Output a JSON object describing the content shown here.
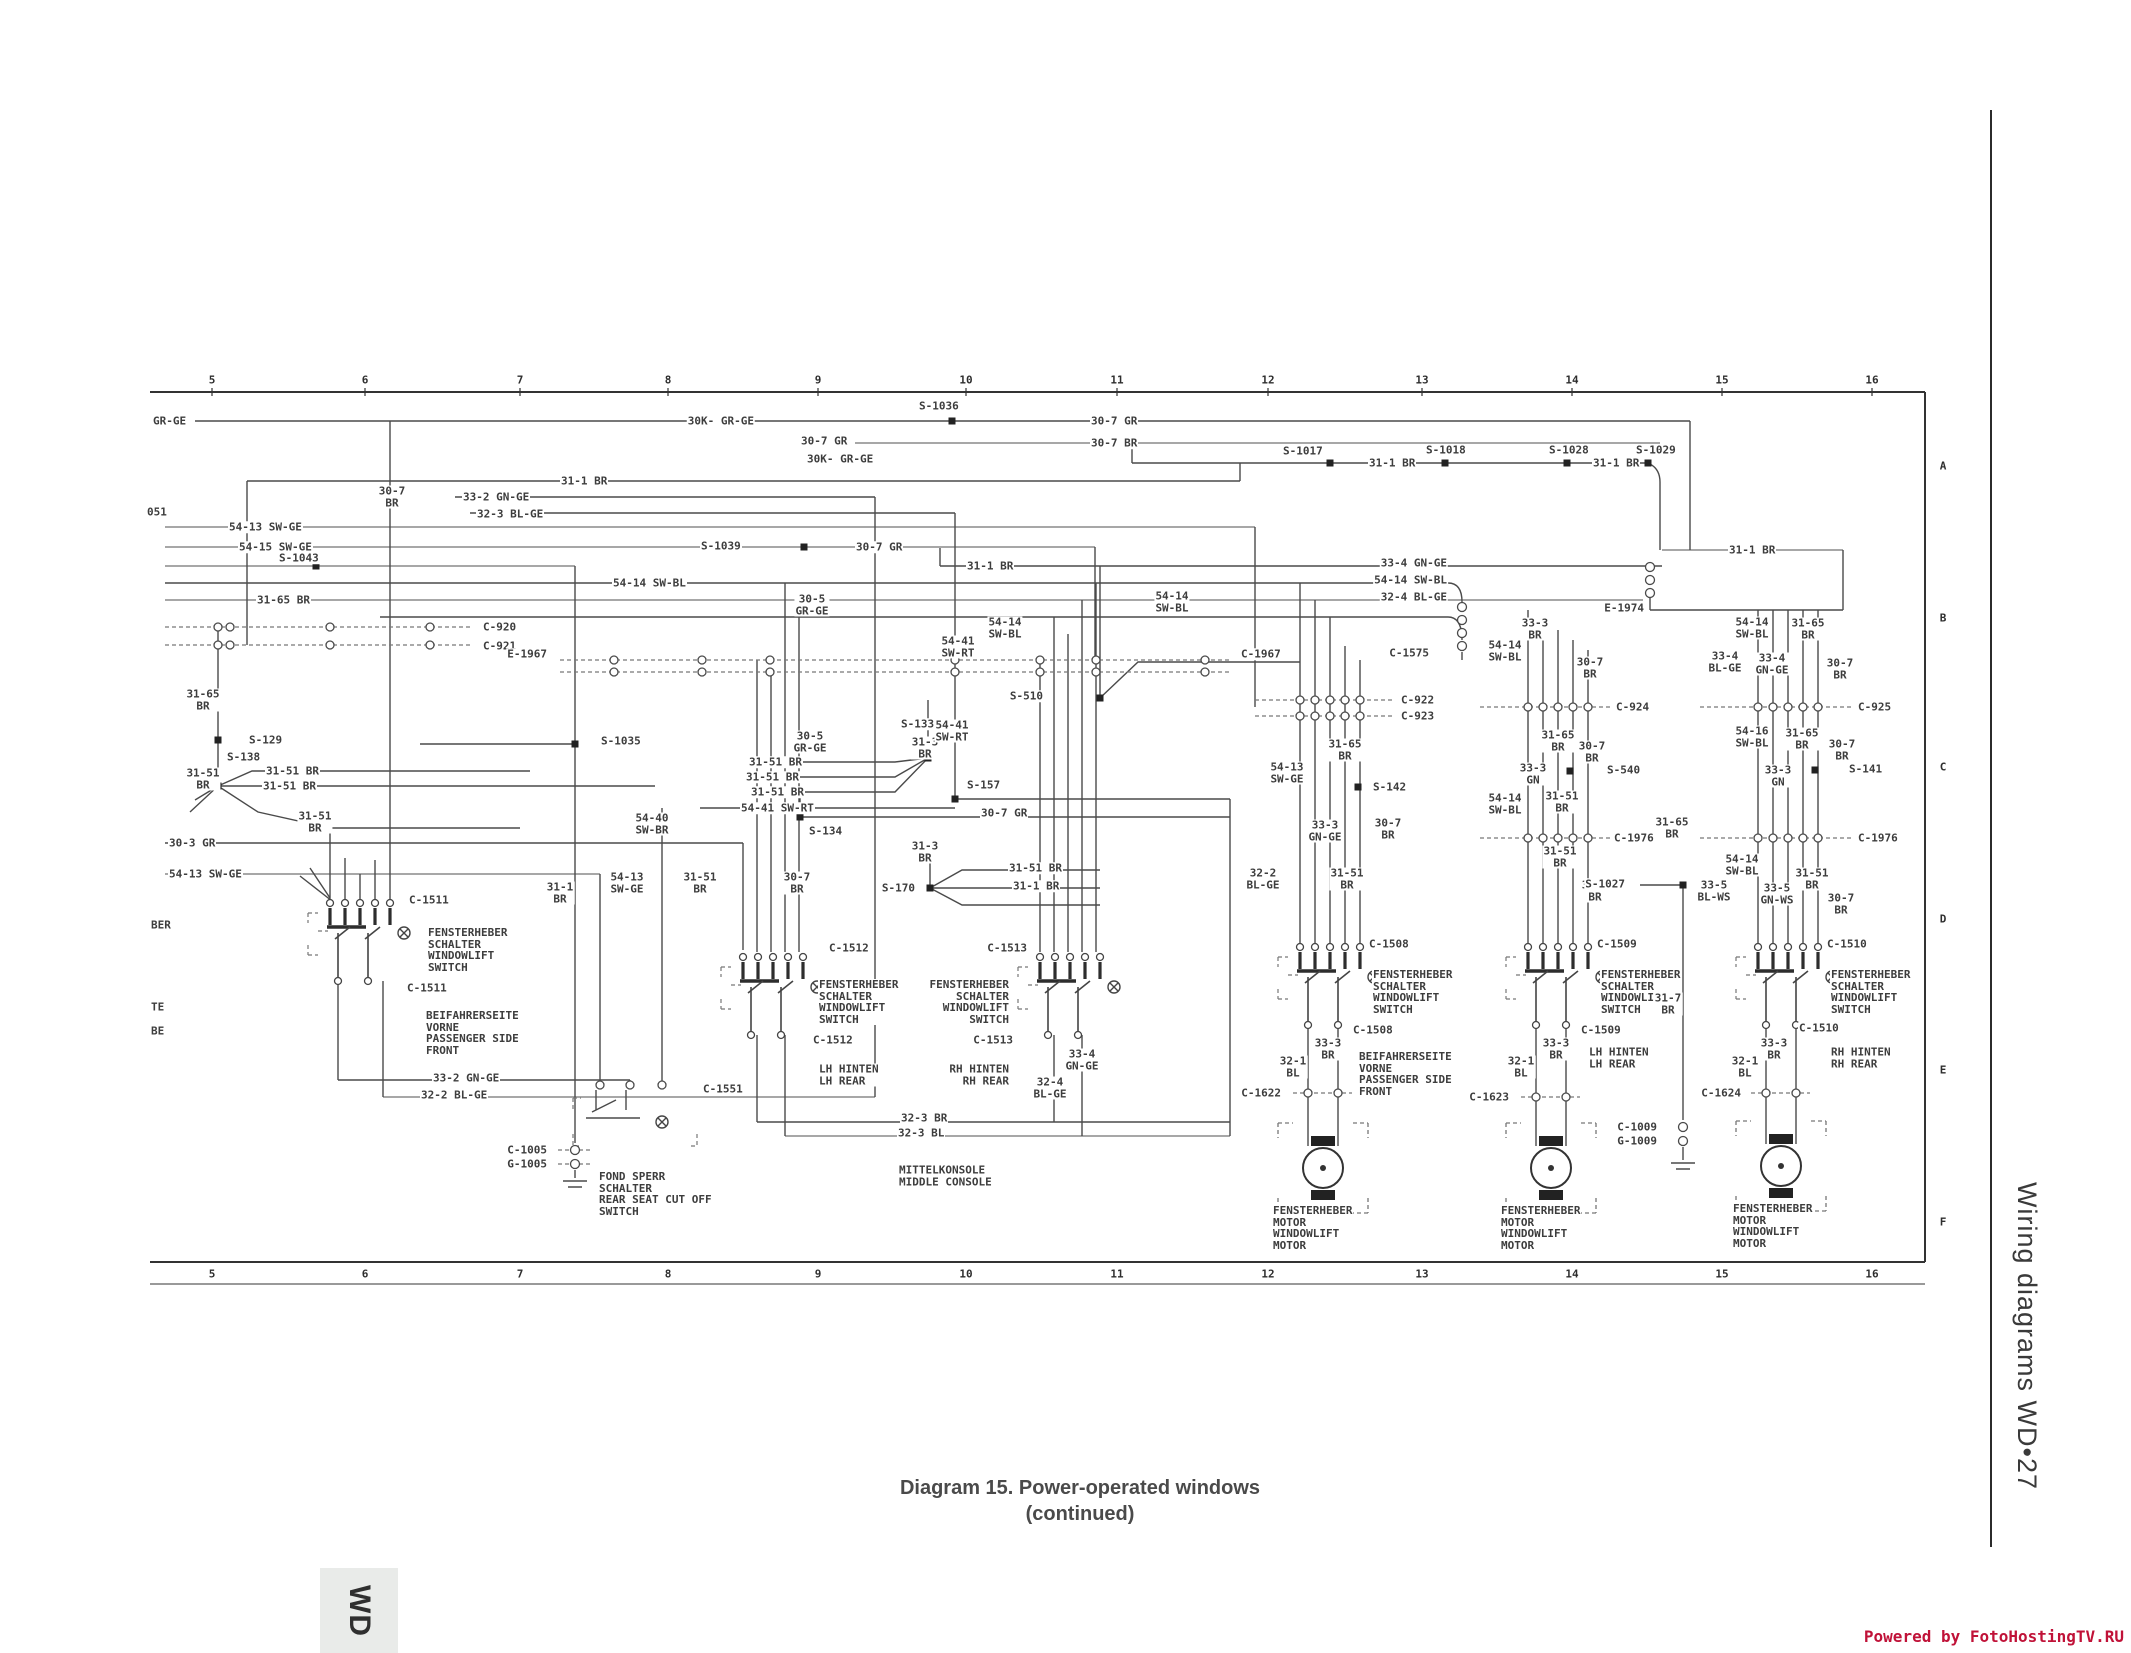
{
  "page": {
    "caption_line1": "Diagram 15. Power-operated windows",
    "caption_line2": "(continued)",
    "sidebar_text": "Wiring diagrams  WD•27",
    "tab_label": "WD",
    "footer_text": "Powered by FotoHostingTV.RU",
    "footer_color": "#c01238"
  },
  "grid": {
    "top_y": 380,
    "bottom_y": 1274,
    "letters_x": 1943,
    "columns": [
      {
        "t": "5",
        "x": 212
      },
      {
        "t": "6",
        "x": 365
      },
      {
        "t": "7",
        "x": 520
      },
      {
        "t": "8",
        "x": 668
      },
      {
        "t": "9",
        "x": 818
      },
      {
        "t": "10",
        "x": 966
      },
      {
        "t": "11",
        "x": 1117
      },
      {
        "t": "12",
        "x": 1268
      },
      {
        "t": "13",
        "x": 1422
      },
      {
        "t": "14",
        "x": 1572
      },
      {
        "t": "15",
        "x": 1722
      },
      {
        "t": "16",
        "x": 1872
      }
    ],
    "letters": [
      {
        "t": "A",
        "y": 466
      },
      {
        "t": "B",
        "y": 618
      },
      {
        "t": "C",
        "y": 767
      },
      {
        "t": "D",
        "y": 919
      },
      {
        "t": "E",
        "y": 1070
      },
      {
        "t": "F",
        "y": 1222
      }
    ]
  },
  "labels": [
    {
      "t": "GR-GE",
      "x": 152,
      "y": 421,
      "a": "s"
    },
    {
      "t": "30K- GR-GE",
      "x": 755,
      "y": 421,
      "a": "e"
    },
    {
      "t": "S-1036",
      "x": 918,
      "y": 406,
      "a": "s"
    },
    {
      "t": "30-7 GR",
      "x": 800,
      "y": 441,
      "a": "s"
    },
    {
      "t": "30K- GR-GE",
      "x": 806,
      "y": 459,
      "a": "s"
    },
    {
      "t": "30-7 GR",
      "x": 1090,
      "y": 421,
      "a": "s"
    },
    {
      "t": "30-7 BR",
      "x": 1090,
      "y": 443,
      "a": "s"
    },
    {
      "t": "31-1 BR",
      "x": 560,
      "y": 481,
      "a": "s"
    },
    {
      "t": "30-7\nBR",
      "x": 392,
      "y": 497,
      "a": "m"
    },
    {
      "t": "33-2 GN-GE",
      "x": 462,
      "y": 497,
      "a": "s"
    },
    {
      "t": "32-3 BL-GE",
      "x": 476,
      "y": 514,
      "a": "s"
    },
    {
      "t": "051",
      "x": 146,
      "y": 512,
      "a": "s"
    },
    {
      "t": "54-13 SW-GE",
      "x": 228,
      "y": 527,
      "a": "s"
    },
    {
      "t": "54-15 SW-GE",
      "x": 238,
      "y": 547,
      "a": "s"
    },
    {
      "t": "S-1043",
      "x": 278,
      "y": 558,
      "a": "s"
    },
    {
      "t": "S-1039",
      "x": 700,
      "y": 546,
      "a": "s"
    },
    {
      "t": "30-7 GR",
      "x": 855,
      "y": 547,
      "a": "s"
    },
    {
      "t": "31-1 BR",
      "x": 966,
      "y": 566,
      "a": "s"
    },
    {
      "t": "S-1017",
      "x": 1282,
      "y": 451,
      "a": "s"
    },
    {
      "t": "31-1 BR",
      "x": 1368,
      "y": 463,
      "a": "s"
    },
    {
      "t": "S-1018",
      "x": 1425,
      "y": 450,
      "a": "s"
    },
    {
      "t": "S-1028",
      "x": 1548,
      "y": 450,
      "a": "s"
    },
    {
      "t": "31-1 BR",
      "x": 1592,
      "y": 463,
      "a": "s"
    },
    {
      "t": "S-1029",
      "x": 1635,
      "y": 450,
      "a": "s"
    },
    {
      "t": "31-1 BR",
      "x": 1728,
      "y": 550,
      "a": "s"
    },
    {
      "t": "31-65 BR",
      "x": 256,
      "y": 600,
      "a": "s"
    },
    {
      "t": "54-14 SW-BL",
      "x": 612,
      "y": 583,
      "a": "s"
    },
    {
      "t": "33-4 GN-GE",
      "x": 1448,
      "y": 563,
      "a": "e"
    },
    {
      "t": "54-14 SW-BL",
      "x": 1448,
      "y": 580,
      "a": "e"
    },
    {
      "t": "32-4 BL-GE",
      "x": 1448,
      "y": 597,
      "a": "e"
    },
    {
      "t": "30-5\nGR-GE",
      "x": 812,
      "y": 605,
      "a": "m"
    },
    {
      "t": "C-920",
      "x": 482,
      "y": 627,
      "a": "s"
    },
    {
      "t": "C-921",
      "x": 482,
      "y": 646,
      "a": "s"
    },
    {
      "t": "E-1967",
      "x": 548,
      "y": 654,
      "a": "e"
    },
    {
      "t": "C-1967",
      "x": 1240,
      "y": 654,
      "a": "s"
    },
    {
      "t": "54-14\nSW-BL",
      "x": 1005,
      "y": 628,
      "a": "m"
    },
    {
      "t": "54-41\nSW-RT",
      "x": 958,
      "y": 647,
      "a": "m"
    },
    {
      "t": "C-1575",
      "x": 1430,
      "y": 653,
      "a": "e"
    },
    {
      "t": "E-1974",
      "x": 1645,
      "y": 608,
      "a": "e"
    },
    {
      "t": "30-5\nGR-GE",
      "x": 810,
      "y": 742,
      "a": "m"
    },
    {
      "t": "31-3\nBR",
      "x": 925,
      "y": 748,
      "a": "m"
    },
    {
      "t": "S-133",
      "x": 900,
      "y": 724,
      "a": "s"
    },
    {
      "t": "54-41\nSW-RT",
      "x": 952,
      "y": 731,
      "a": "m"
    },
    {
      "t": "31-65\nBR",
      "x": 203,
      "y": 700,
      "a": "m"
    },
    {
      "t": "S-129",
      "x": 248,
      "y": 740,
      "a": "s"
    },
    {
      "t": "31-51\nBR",
      "x": 203,
      "y": 779,
      "a": "m"
    },
    {
      "t": "S-138",
      "x": 226,
      "y": 757,
      "a": "s"
    },
    {
      "t": "31-51 BR",
      "x": 265,
      "y": 771,
      "a": "s"
    },
    {
      "t": "31-51 BR",
      "x": 262,
      "y": 786,
      "a": "s"
    },
    {
      "t": "31-51\nBR",
      "x": 315,
      "y": 822,
      "a": "m"
    },
    {
      "t": "30-3 GR",
      "x": 168,
      "y": 843,
      "a": "s"
    },
    {
      "t": "54-13 SW-GE",
      "x": 168,
      "y": 874,
      "a": "s"
    },
    {
      "t": "BER",
      "x": 150,
      "y": 925,
      "a": "s"
    },
    {
      "t": "TE",
      "x": 150,
      "y": 1007,
      "a": "s"
    },
    {
      "t": "BE",
      "x": 150,
      "y": 1031,
      "a": "s"
    },
    {
      "t": "S-1035",
      "x": 600,
      "y": 741,
      "a": "s"
    },
    {
      "t": "54-40\nSW-BR",
      "x": 652,
      "y": 824,
      "a": "m"
    },
    {
      "t": "31-1\nBR",
      "x": 560,
      "y": 893,
      "a": "m"
    },
    {
      "t": "54-13\nSW-GE",
      "x": 627,
      "y": 883,
      "a": "m"
    },
    {
      "t": "31-51\nBR",
      "x": 700,
      "y": 883,
      "a": "m"
    },
    {
      "t": "30-7\nBR",
      "x": 797,
      "y": 883,
      "a": "m"
    },
    {
      "t": "31-51 BR",
      "x": 748,
      "y": 762,
      "a": "s"
    },
    {
      "t": "31-51 BR",
      "x": 745,
      "y": 777,
      "a": "s"
    },
    {
      "t": "31-51 BR",
      "x": 750,
      "y": 792,
      "a": "s"
    },
    {
      "t": "54-41 SW-RT",
      "x": 740,
      "y": 808,
      "a": "s"
    },
    {
      "t": "S-134",
      "x": 808,
      "y": 831,
      "a": "s"
    },
    {
      "t": "30-7 GR",
      "x": 980,
      "y": 813,
      "a": "s"
    },
    {
      "t": "S-157",
      "x": 966,
      "y": 785,
      "a": "s"
    },
    {
      "t": "31-3\nBR",
      "x": 925,
      "y": 852,
      "a": "m"
    },
    {
      "t": "S-170",
      "x": 916,
      "y": 888,
      "a": "e"
    },
    {
      "t": "31-51 BR",
      "x": 1008,
      "y": 868,
      "a": "s"
    },
    {
      "t": "31-1 BR",
      "x": 1012,
      "y": 886,
      "a": "s"
    },
    {
      "t": "C-1511",
      "x": 408,
      "y": 900,
      "a": "s"
    },
    {
      "t": "FENSTERHEBER\nSCHALTER\nWINDOWLIFT\nSWITCH",
      "x": 427,
      "y": 950,
      "a": "s"
    },
    {
      "t": "C-1511",
      "x": 406,
      "y": 988,
      "a": "s"
    },
    {
      "t": "BEIFAHRERSEITE\nVORNE\nPASSENGER SIDE\nFRONT",
      "x": 425,
      "y": 1033,
      "a": "s"
    },
    {
      "t": "33-2 GN-GE",
      "x": 432,
      "y": 1078,
      "a": "s"
    },
    {
      "t": "32-2 BL-GE",
      "x": 420,
      "y": 1095,
      "a": "s"
    },
    {
      "t": "C-1551",
      "x": 702,
      "y": 1089,
      "a": "s"
    },
    {
      "t": "FOND SPERR\nSCHALTER\nREAR SEAT CUT OFF\nSWITCH",
      "x": 598,
      "y": 1194,
      "a": "s"
    },
    {
      "t": "C-1005",
      "x": 548,
      "y": 1150,
      "a": "e"
    },
    {
      "t": "G-1005",
      "x": 548,
      "y": 1164,
      "a": "e"
    },
    {
      "t": "MITTELKONSOLE\nMIDDLE CONSOLE",
      "x": 898,
      "y": 1176,
      "a": "s"
    },
    {
      "t": "32-3 BR",
      "x": 900,
      "y": 1118,
      "a": "s"
    },
    {
      "t": "32-3 BL",
      "x": 897,
      "y": 1133,
      "a": "s"
    },
    {
      "t": "C-1512",
      "x": 828,
      "y": 948,
      "a": "s"
    },
    {
      "t": "FENSTERHEBER\nSCHALTER\nWINDOWLIFT\nSWITCH",
      "x": 818,
      "y": 1002,
      "a": "s"
    },
    {
      "t": "C-1512",
      "x": 812,
      "y": 1040,
      "a": "s"
    },
    {
      "t": "LH HINTEN\nLH REAR",
      "x": 818,
      "y": 1075,
      "a": "s"
    },
    {
      "t": "C-1513",
      "x": 1028,
      "y": 948,
      "a": "e"
    },
    {
      "t": "FENSTERHEBER\nSCHALTER\nWINDOWLIFT\nSWITCH",
      "x": 1010,
      "y": 1002,
      "a": "e"
    },
    {
      "t": "C-1513",
      "x": 1014,
      "y": 1040,
      "a": "e"
    },
    {
      "t": "RH HINTEN\nRH REAR",
      "x": 1010,
      "y": 1075,
      "a": "e"
    },
    {
      "t": "33-4\nGN-GE",
      "x": 1082,
      "y": 1060,
      "a": "m"
    },
    {
      "t": "32-4\nBL-GE",
      "x": 1050,
      "y": 1088,
      "a": "m"
    },
    {
      "t": "54-14\nSW-BL",
      "x": 1172,
      "y": 602,
      "a": "m"
    },
    {
      "t": "S-510",
      "x": 1044,
      "y": 696,
      "a": "e"
    },
    {
      "t": "C-922",
      "x": 1400,
      "y": 700,
      "a": "s"
    },
    {
      "t": "C-923",
      "x": 1400,
      "y": 716,
      "a": "s"
    },
    {
      "t": "31-65\nBR",
      "x": 1345,
      "y": 750,
      "a": "m"
    },
    {
      "t": "54-13\nSW-GE",
      "x": 1287,
      "y": 773,
      "a": "m"
    },
    {
      "t": "S-142",
      "x": 1372,
      "y": 787,
      "a": "s"
    },
    {
      "t": "33-3\nGN-GE",
      "x": 1325,
      "y": 831,
      "a": "m"
    },
    {
      "t": "30-7\nBR",
      "x": 1388,
      "y": 829,
      "a": "m"
    },
    {
      "t": "32-2\nBL-GE",
      "x": 1263,
      "y": 879,
      "a": "m"
    },
    {
      "t": "31-51\nBR",
      "x": 1347,
      "y": 879,
      "a": "m"
    },
    {
      "t": "33-3\nBR",
      "x": 1535,
      "y": 629,
      "a": "m"
    },
    {
      "t": "54-14\nSW-BL",
      "x": 1505,
      "y": 651,
      "a": "m"
    },
    {
      "t": "30-7\nBR",
      "x": 1590,
      "y": 668,
      "a": "m"
    },
    {
      "t": "C-924",
      "x": 1615,
      "y": 707,
      "a": "s"
    },
    {
      "t": "31-65\nBR",
      "x": 1558,
      "y": 741,
      "a": "m"
    },
    {
      "t": "30-7\nBR",
      "x": 1592,
      "y": 752,
      "a": "m"
    },
    {
      "t": "33-3\nGN",
      "x": 1533,
      "y": 774,
      "a": "m"
    },
    {
      "t": "S-540",
      "x": 1606,
      "y": 770,
      "a": "s"
    },
    {
      "t": "31-51\nBR",
      "x": 1562,
      "y": 802,
      "a": "m"
    },
    {
      "t": "54-14\nSW-BL",
      "x": 1505,
      "y": 804,
      "a": "m"
    },
    {
      "t": "C-1976",
      "x": 1613,
      "y": 838,
      "a": "s"
    },
    {
      "t": "31-65\nBR",
      "x": 1672,
      "y": 828,
      "a": "m"
    },
    {
      "t": "31-51\nBR",
      "x": 1560,
      "y": 857,
      "a": "m"
    },
    {
      "t": "30-7\nBR",
      "x": 1595,
      "y": 891,
      "a": "m"
    },
    {
      "t": "S-1027",
      "x": 1626,
      "y": 884,
      "a": "e"
    },
    {
      "t": "54-14\nSW-BL",
      "x": 1752,
      "y": 628,
      "a": "m"
    },
    {
      "t": "31-65\nBR",
      "x": 1808,
      "y": 629,
      "a": "m"
    },
    {
      "t": "33-4\nBL-GE",
      "x": 1725,
      "y": 662,
      "a": "m"
    },
    {
      "t": "33-4\nGN-GE",
      "x": 1772,
      "y": 664,
      "a": "m"
    },
    {
      "t": "30-7\nBR",
      "x": 1840,
      "y": 669,
      "a": "m"
    },
    {
      "t": "C-925",
      "x": 1857,
      "y": 707,
      "a": "s"
    },
    {
      "t": "54-16\nSW-BL",
      "x": 1752,
      "y": 737,
      "a": "m"
    },
    {
      "t": "31-65\nBR",
      "x": 1802,
      "y": 739,
      "a": "m"
    },
    {
      "t": "30-7\nBR",
      "x": 1842,
      "y": 750,
      "a": "m"
    },
    {
      "t": "33-3\nGN",
      "x": 1778,
      "y": 776,
      "a": "m"
    },
    {
      "t": "S-141",
      "x": 1848,
      "y": 769,
      "a": "s"
    },
    {
      "t": "C-1976",
      "x": 1857,
      "y": 838,
      "a": "s"
    },
    {
      "t": "54-14\nSW-BL",
      "x": 1742,
      "y": 865,
      "a": "m"
    },
    {
      "t": "31-51\nBR",
      "x": 1812,
      "y": 879,
      "a": "m"
    },
    {
      "t": "33-5\nBL-WS",
      "x": 1714,
      "y": 891,
      "a": "m"
    },
    {
      "t": "33-5\nGN-WS",
      "x": 1777,
      "y": 894,
      "a": "m"
    },
    {
      "t": "30-7\nBR",
      "x": 1841,
      "y": 904,
      "a": "m"
    },
    {
      "t": "C-1508",
      "x": 1368,
      "y": 944,
      "a": "s"
    },
    {
      "t": "FENSTERHEBER\nSCHALTER\nWINDOWLIFT\nSWITCH",
      "x": 1372,
      "y": 992,
      "a": "s"
    },
    {
      "t": "C-1508",
      "x": 1352,
      "y": 1030,
      "a": "s"
    },
    {
      "t": "33-3\nBR",
      "x": 1328,
      "y": 1049,
      "a": "m"
    },
    {
      "t": "32-1\nBL",
      "x": 1293,
      "y": 1067,
      "a": "m"
    },
    {
      "t": "BEIFAHRERSEITE\nVORNE\nPASSENGER SIDE\nFRONT",
      "x": 1358,
      "y": 1074,
      "a": "s"
    },
    {
      "t": "C-1622",
      "x": 1282,
      "y": 1093,
      "a": "e"
    },
    {
      "t": "FENSTERHEBER\nMOTOR\nWINDOWLIFT\nMOTOR",
      "x": 1272,
      "y": 1228,
      "a": "s"
    },
    {
      "t": "C-1509",
      "x": 1596,
      "y": 944,
      "a": "s"
    },
    {
      "t": "FENSTERHEBER\nSCHALTER\nWINDOWLIFT\nSWITCH",
      "x": 1600,
      "y": 992,
      "a": "s"
    },
    {
      "t": "C-1509",
      "x": 1580,
      "y": 1030,
      "a": "s"
    },
    {
      "t": "33-3\nBR",
      "x": 1556,
      "y": 1049,
      "a": "m"
    },
    {
      "t": "32-1\nBL",
      "x": 1521,
      "y": 1067,
      "a": "m"
    },
    {
      "t": "LH HINTEN\nLH REAR",
      "x": 1588,
      "y": 1058,
      "a": "s"
    },
    {
      "t": "C-1623",
      "x": 1510,
      "y": 1097,
      "a": "e"
    },
    {
      "t": "FENSTERHEBER\nMOTOR\nWINDOWLIFT\nMOTOR",
      "x": 1500,
      "y": 1228,
      "a": "s"
    },
    {
      "t": "31-7\nBR",
      "x": 1668,
      "y": 1004,
      "a": "m"
    },
    {
      "t": "C-1009",
      "x": 1658,
      "y": 1127,
      "a": "e"
    },
    {
      "t": "G-1009",
      "x": 1658,
      "y": 1141,
      "a": "e"
    },
    {
      "t": "C-1510",
      "x": 1826,
      "y": 944,
      "a": "s"
    },
    {
      "t": "FENSTERHEBER\nSCHALTER\nWINDOWLIFT\nSWITCH",
      "x": 1830,
      "y": 992,
      "a": "s"
    },
    {
      "t": "C-1510",
      "x": 1798,
      "y": 1028,
      "a": "s"
    },
    {
      "t": "33-3\nBR",
      "x": 1774,
      "y": 1049,
      "a": "m"
    },
    {
      "t": "32-1\nBL",
      "x": 1745,
      "y": 1067,
      "a": "m"
    },
    {
      "t": "RH HINTEN\nRH REAR",
      "x": 1830,
      "y": 1058,
      "a": "s"
    },
    {
      "t": "C-1624",
      "x": 1742,
      "y": 1093,
      "a": "e"
    },
    {
      "t": "FENSTERHEBER\nMOTOR\nWINDOWLIFT\nMOTOR",
      "x": 1732,
      "y": 1226,
      "a": "s"
    }
  ]
}
